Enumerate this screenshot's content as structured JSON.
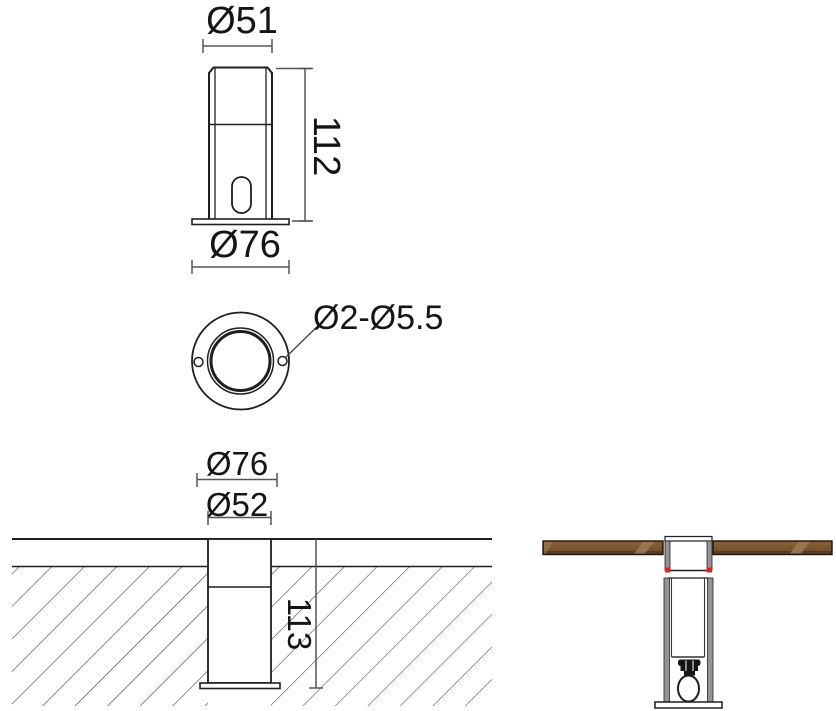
{
  "drawing": {
    "type": "technical dimension drawing of an outdoor bollard light fixture",
    "views": {
      "front": {
        "name": "front elevation",
        "dim_top_diameter": "Ø51",
        "dim_height": "112",
        "dim_base_diameter": "Ø76"
      },
      "top": {
        "name": "top view",
        "dim_mounting_holes": "Ø2-Ø5.5"
      },
      "ground": {
        "name": "in-ground installation section",
        "dim_flange_diameter": "Ø76",
        "dim_body_diameter": "Ø52",
        "dim_embed_depth": "113"
      },
      "deck": {
        "name": "deck installation section"
      }
    },
    "colors": {
      "background": "#ffffff",
      "object_line": "#1f1f1f",
      "dimension_line": "#555555",
      "wood": "#7b5531",
      "wood_highlight": "#9d7a50",
      "metal_gray": "#949494",
      "accent_red": "#e0211c"
    }
  }
}
